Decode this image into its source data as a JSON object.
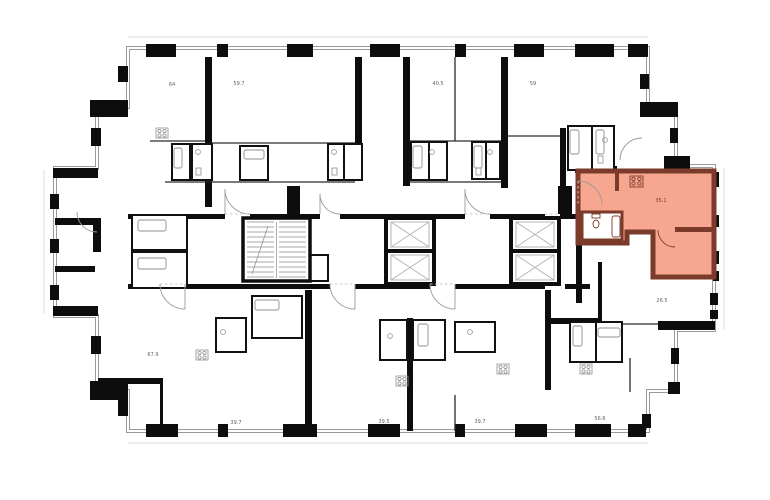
{
  "plan": {
    "units": [
      {
        "id": "top-1",
        "label": "64",
        "highlighted": false
      },
      {
        "id": "top-2",
        "label": "59.7",
        "highlighted": false
      },
      {
        "id": "top-3",
        "label": "40.5",
        "highlighted": false
      },
      {
        "id": "top-4",
        "label": "59",
        "highlighted": false
      },
      {
        "id": "right-sel",
        "label": "35.1",
        "highlighted": true
      },
      {
        "id": "right-mid",
        "label": "26.5",
        "highlighted": false
      },
      {
        "id": "bottom-1",
        "label": "67.9",
        "highlighted": false
      },
      {
        "id": "bottom-2",
        "label": "39.7",
        "highlighted": false
      },
      {
        "id": "bottom-3",
        "label": "39.5",
        "highlighted": false
      },
      {
        "id": "bottom-4",
        "label": "39.7",
        "highlighted": false
      },
      {
        "id": "bottom-5",
        "label": "56.6",
        "highlighted": false
      }
    ],
    "colors": {
      "highlight_fill": "#f7a68f",
      "highlight_wall": "#7b3a2a",
      "wall": "#0d0d0d",
      "label_gray": "#5f5f5f"
    }
  }
}
